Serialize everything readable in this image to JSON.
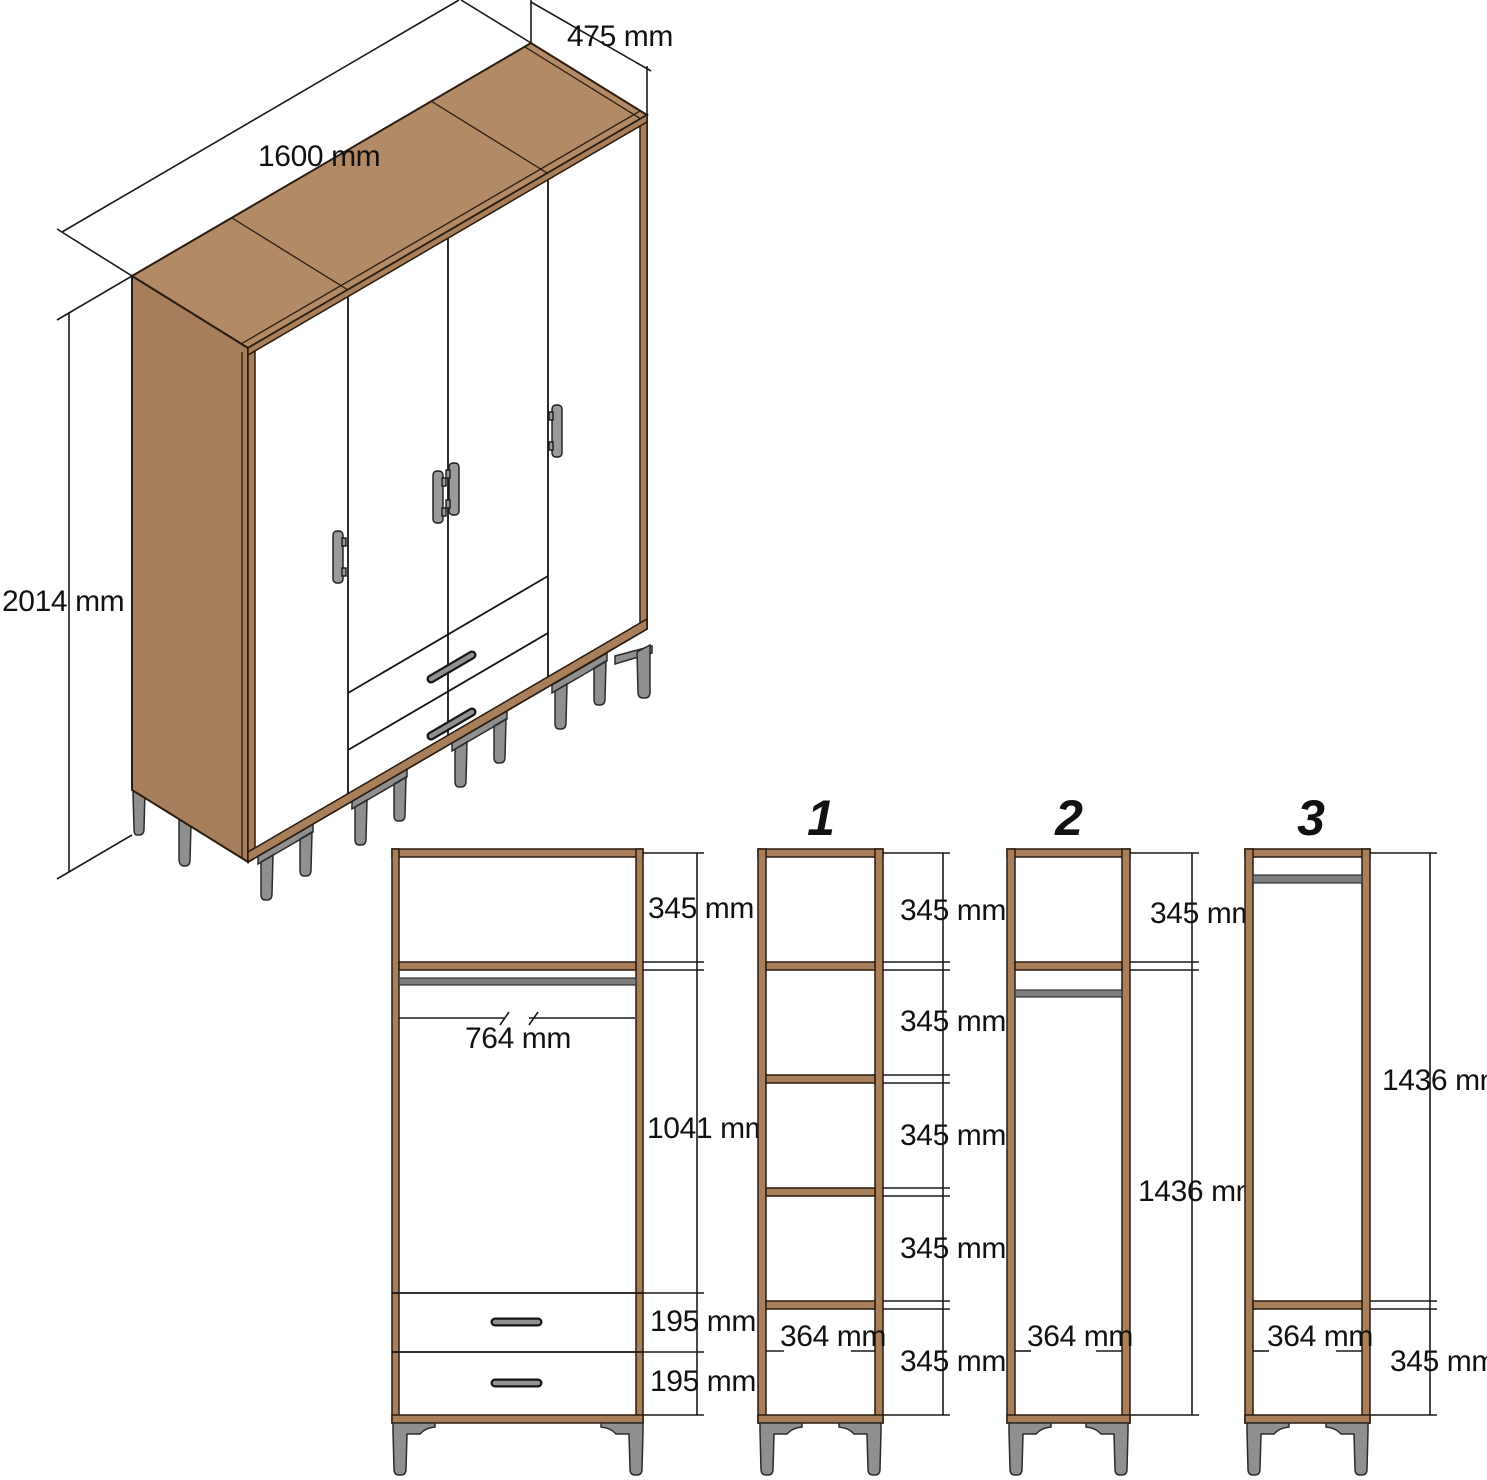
{
  "page": {
    "title": "Wardrobe technical dimension diagram"
  },
  "colors": {
    "wood_top": "#b28a66",
    "wood_side": "#a67e5b",
    "wood_frame": "#a97f5b",
    "outline": "#2a1c10",
    "dimension_line": "#1a1a1a",
    "metal_leg": "#8f8f8f",
    "hanging_rail": "#7d7d7d",
    "panel": "#ffffff"
  },
  "iso": {
    "width_label": "1600 mm",
    "depth_label": "475 mm",
    "height_label": "2014 mm"
  },
  "front": {
    "main": {
      "top_shelf": "345 mm",
      "rail_width": "764 mm",
      "hanging": "1041 mm",
      "drawer1": "195 mm",
      "drawer2": "195 mm"
    },
    "opt1": {
      "number": "1",
      "c1": "345 mm",
      "c2": "345 mm",
      "c3": "345 mm",
      "c4": "345 mm",
      "c5": "345 mm",
      "width": "364 mm"
    },
    "opt2": {
      "number": "2",
      "top": "345 mm",
      "tall": "1436 mm",
      "width": "364 mm"
    },
    "opt3": {
      "number": "3",
      "tall": "1436 mm",
      "bottom": "345 mm",
      "width": "364 mm"
    }
  }
}
